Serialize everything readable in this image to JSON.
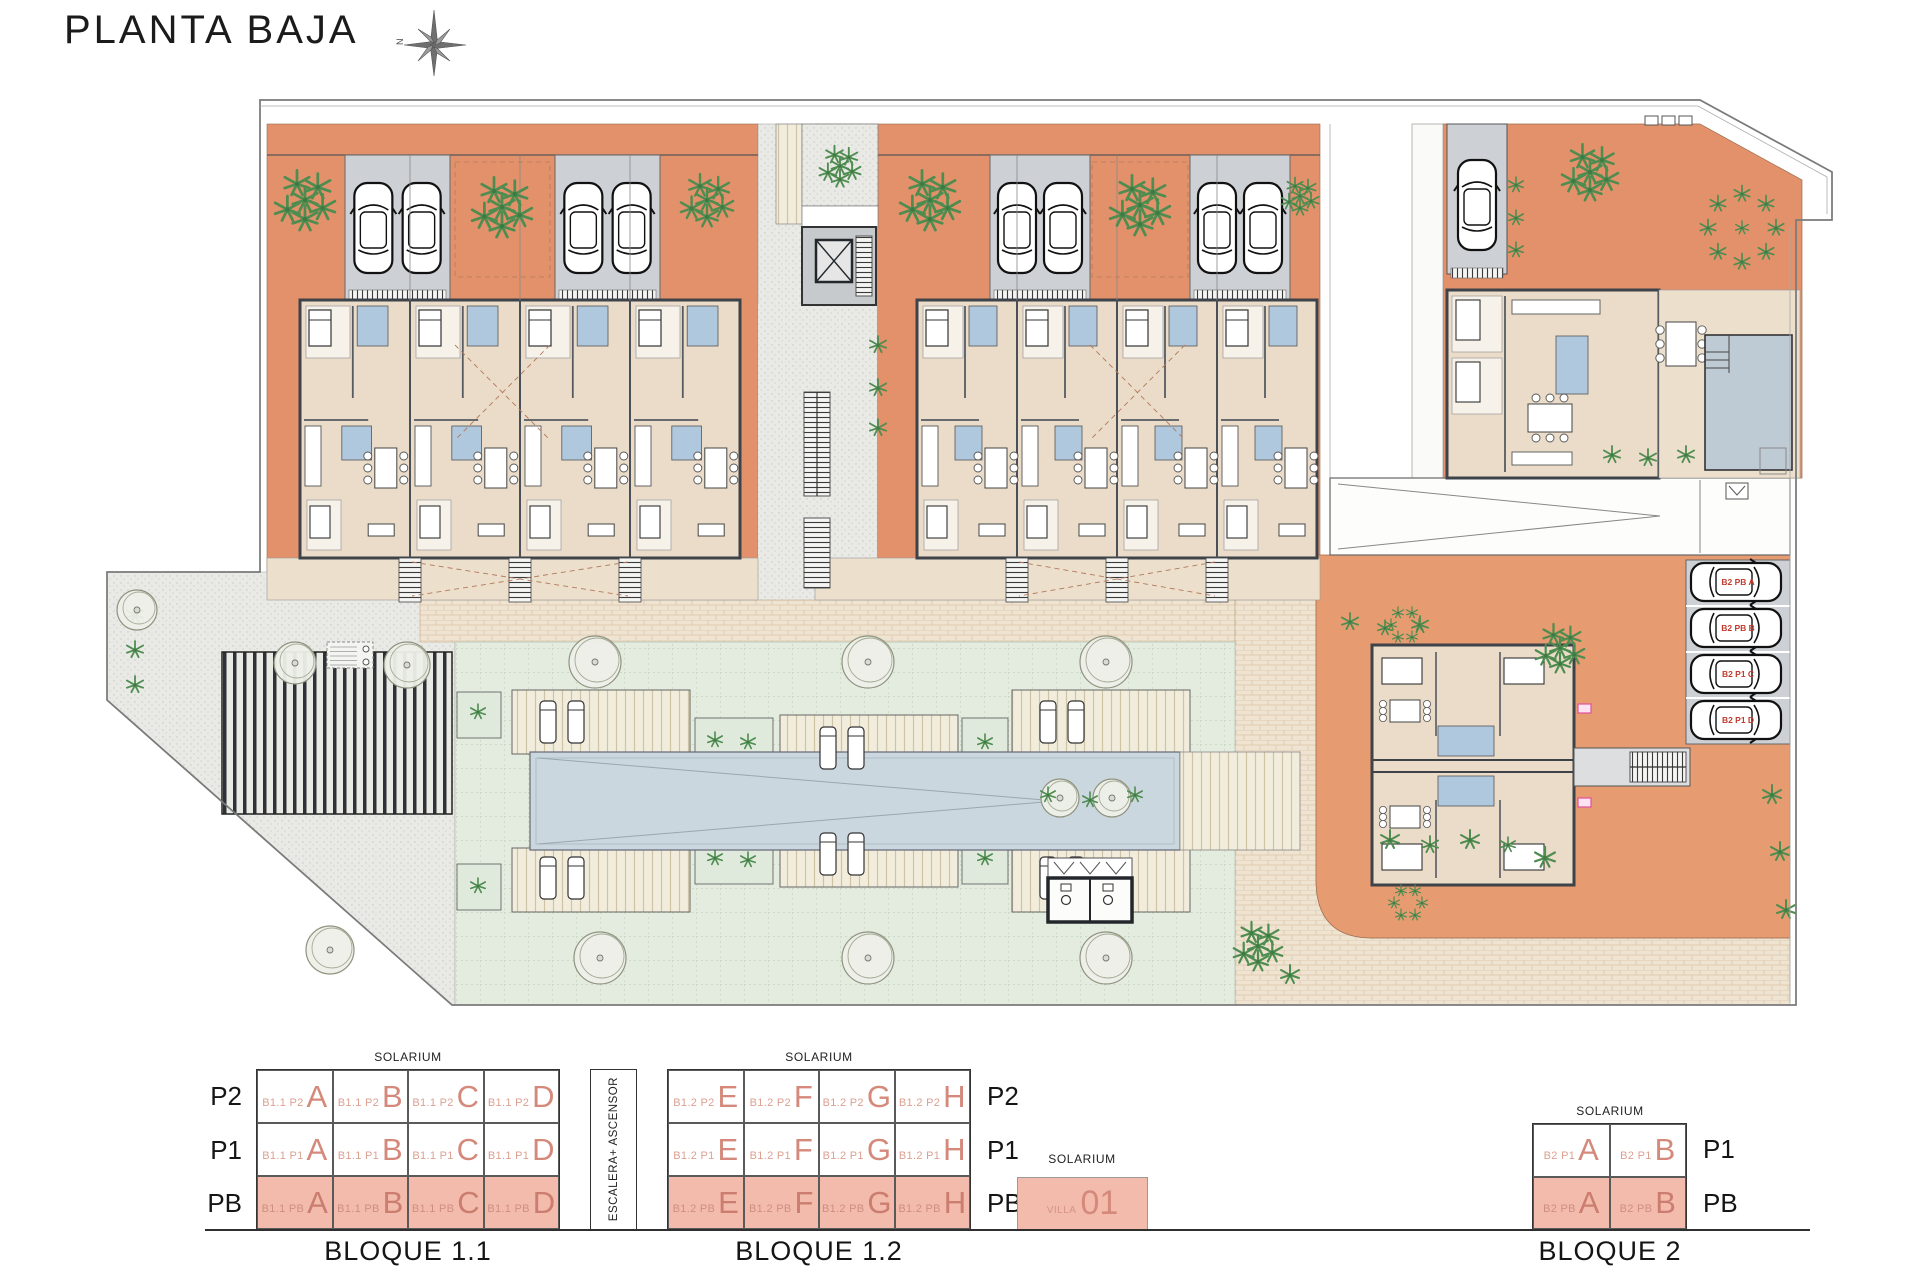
{
  "title": "PLANTA BAJA",
  "compass": {
    "north_label": "N"
  },
  "plan": {
    "parking_labels": [
      "B2 PB A",
      "B2 PB B",
      "B2 P1 C",
      "B2 P1 D"
    ],
    "colors": {
      "terracotta": "#E2916B",
      "terracotta_light": "#E69B70",
      "beige_floor": "#EADCC8",
      "terrace": "#ECDFCC",
      "garage_gray": "#CDD0D4",
      "bath_blue": "#AFC8DD",
      "pool_blue": "#CBD7DE",
      "villa_pool": "#BFCBD4",
      "lawn": "#E3ECDF",
      "salmon": "#F3BBAC",
      "unit_letter": "#D4897B",
      "label_red": "#C23B2E",
      "pink_tag": "#E0529E"
    }
  },
  "legend": {
    "solarium": "SOLARIUM",
    "escalera": "ESCALERA+ ASCENSOR",
    "bloque11": {
      "title": "BLOQUE 1.1",
      "prefix": "B1.1",
      "floors": [
        "P2",
        "P1",
        "PB"
      ],
      "units": [
        "A",
        "B",
        "C",
        "D"
      ],
      "ground_floor": "PB"
    },
    "bloque12": {
      "title": "BLOQUE 1.2",
      "prefix": "B1.2",
      "floors": [
        "P2",
        "P1",
        "PB"
      ],
      "units": [
        "E",
        "F",
        "G",
        "H"
      ],
      "ground_floor": "PB"
    },
    "villa": {
      "name": "VILLA",
      "number": "01"
    },
    "bloque2": {
      "title": "BLOQUE 2",
      "prefix": "B2",
      "floors": [
        "P1",
        "PB"
      ],
      "units": [
        "A",
        "B"
      ],
      "ground_floor": "PB"
    }
  }
}
